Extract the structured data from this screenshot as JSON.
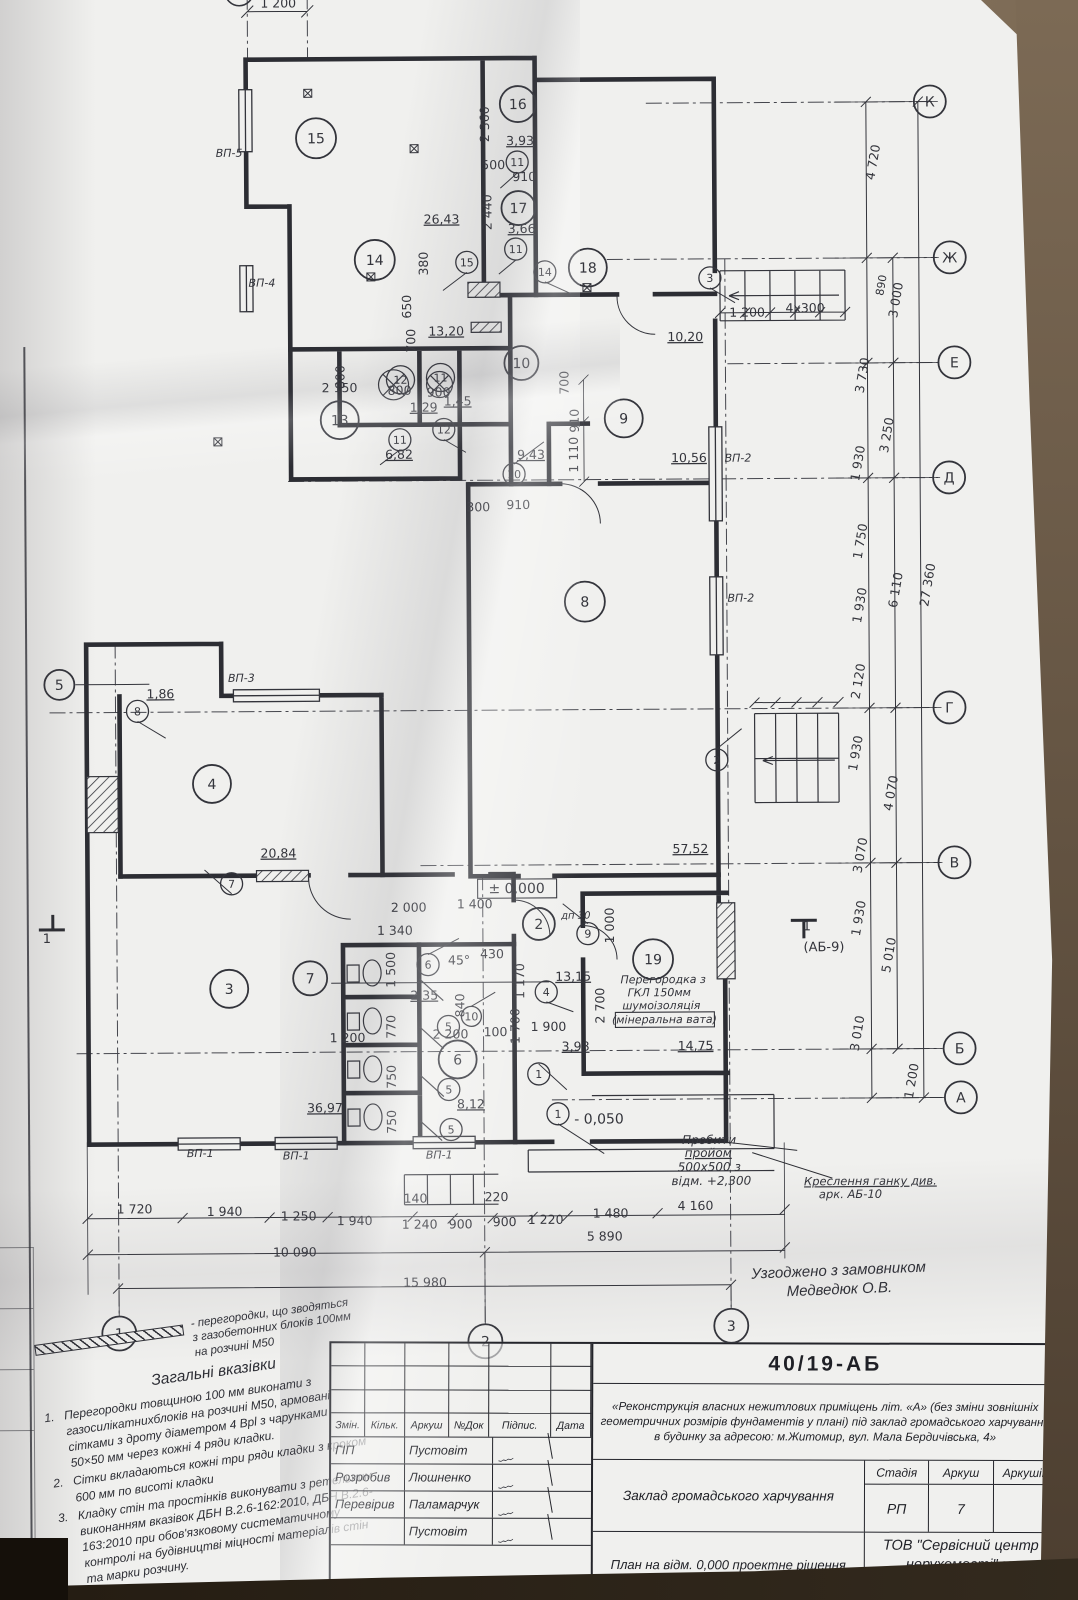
{
  "agreement": {
    "line1": "Узгоджено з замовником",
    "line2": "Медведюк О.В."
  },
  "notes": {
    "legend": "- перегородки, що зводяться з газобетонних блоків 100мм на розчині М50",
    "title": "Загальні вказівки",
    "items": [
      {
        "num": "1.",
        "text": "Перегородки товщиною 100 мм виконати з газосилікатнихблоків на розчині М50, армовані сітками з дроту діаметром 4 Врl з чарунками 50×50 мм через кожні 4 ряди кладки."
      },
      {
        "num": "2.",
        "text": "Сітки вкладаються кожні три ряди кладки з кроком 600 мм по висоті кладки"
      },
      {
        "num": "3.",
        "text": "Кладку стін та простінків виконувати з ретельним виконанням вказівок ДБН В.2.6-162:2010, ДБН В.2.6-163:2010 при обов'язковому систематичному контролі на будівництві міцності матеріалів стін та марки розчину."
      }
    ]
  },
  "titleblock": {
    "doc_number": "40/19-АБ",
    "project_text": "«Реконструкція власних нежитлових приміщень літ. «А» (без зміни зовнішніх геометричних розмірів фундаментів у плані) під заклад громадського харчування в будинку за адресою: м.Житомир, вул. Мала Бердичівська, 4»",
    "object_label": "Заклад громадського харчування",
    "stage_header": "Стадія",
    "sheet_header": "Аркуш",
    "sheets_header": "Аркушів",
    "stage_value": "РП",
    "sheet_value": "7",
    "sheets_value": "",
    "drawing_title": "План на відм. 0,000 проектне рішення",
    "org": "ТОВ \"Сервісний центр нерухомості\" м. Житомир.",
    "sig_headers": [
      "Змін.",
      "Кільк.",
      "Аркуш",
      "№Док",
      "Підпис.",
      "Дата"
    ],
    "sig_rows": [
      {
        "role": "ГІП",
        "name": "Пустовіт"
      },
      {
        "role": "Розробив",
        "name": "Люшненко"
      },
      {
        "role": "Перевірив",
        "name": "Паламарчук"
      },
      {
        "role": "",
        "name": "Пустовіт"
      }
    ]
  },
  "plan": {
    "ink": "#33343b",
    "texts": [
      {
        "t": "1 200",
        "x": 293,
        "y": 14
      },
      {
        "t": "2 360",
        "x": 503,
        "y": 132,
        "r": -90
      },
      {
        "t": "3,93",
        "x": 534,
        "y": 153,
        "u": 1
      },
      {
        "t": "500",
        "x": 507,
        "y": 177
      },
      {
        "t": "910",
        "x": 538,
        "y": 189
      },
      {
        "t": "2 440",
        "x": 505,
        "y": 220,
        "r": -90
      },
      {
        "t": "3,66",
        "x": 535,
        "y": 241,
        "u": 1
      },
      {
        "t": "26,43",
        "x": 455,
        "y": 231,
        "u": 1,
        "n": "area-label"
      },
      {
        "t": "380",
        "x": 441,
        "y": 271,
        "r": -90
      },
      {
        "t": "650",
        "x": 424,
        "y": 314,
        "r": -90
      },
      {
        "t": "700",
        "x": 428,
        "y": 348,
        "r": -90
      },
      {
        "t": "13,20",
        "x": 459,
        "y": 343,
        "u": 1,
        "n": "area-label"
      },
      {
        "t": "10,20",
        "x": 698,
        "y": 350,
        "u": 1,
        "n": "area-label"
      },
      {
        "t": "1 200",
        "x": 760,
        "y": 326
      },
      {
        "t": "4x300",
        "x": 818,
        "y": 322
      },
      {
        "t": "800",
        "x": 357,
        "y": 384,
        "r": -90
      },
      {
        "t": "2 150",
        "x": 352,
        "y": 399
      },
      {
        "t": "800",
        "x": 412,
        "y": 402
      },
      {
        "t": "900",
        "x": 451,
        "y": 404
      },
      {
        "t": "700",
        "x": 581,
        "y": 391,
        "r": -90
      },
      {
        "t": "910",
        "x": 591,
        "y": 429,
        "r": -90
      },
      {
        "t": "1 110",
        "x": 590,
        "y": 463,
        "r": -90
      },
      {
        "t": "1,29",
        "x": 436,
        "y": 419,
        "u": 1
      },
      {
        "t": "1,45",
        "x": 470,
        "y": 413,
        "u": 1
      },
      {
        "t": "6,82",
        "x": 411,
        "y": 466,
        "u": 1,
        "n": "area-label"
      },
      {
        "t": "9,43",
        "x": 543,
        "y": 467,
        "u": 1,
        "n": "area-label"
      },
      {
        "t": "10,56",
        "x": 701,
        "y": 471,
        "u": 1,
        "n": "area-label"
      },
      {
        "t": "300",
        "x": 490,
        "y": 519
      },
      {
        "t": "910",
        "x": 530,
        "y": 517
      },
      {
        "t": "1,86",
        "x": 171,
        "y": 704,
        "u": 1
      },
      {
        "t": "20,84",
        "x": 288,
        "y": 864,
        "u": 1,
        "n": "area-label"
      },
      {
        "t": "57,52",
        "x": 700,
        "y": 862,
        "u": 1,
        "n": "area-label"
      },
      {
        "t": "± 0,000",
        "x": 526,
        "y": 901,
        "s": 14,
        "n": "level-mark"
      },
      {
        "t": "2 000",
        "x": 418,
        "y": 919
      },
      {
        "t": "1 400",
        "x": 484,
        "y": 916
      },
      {
        "t": "1 340",
        "x": 404,
        "y": 942
      },
      {
        "t": "1 000",
        "x": 623,
        "y": 934,
        "r": -90
      },
      {
        "t": "дп 30",
        "x": 585,
        "y": 927,
        "s": 10,
        "i": 1
      },
      {
        "t": "45°",
        "x": 468,
        "y": 972
      },
      {
        "t": "430",
        "x": 501,
        "y": 966
      },
      {
        "t": "1 170",
        "x": 533,
        "y": 989,
        "r": -90
      },
      {
        "t": "13,15",
        "x": 582,
        "y": 989,
        "u": 1,
        "n": "area-label"
      },
      {
        "t": "2,35",
        "x": 433,
        "y": 1007,
        "u": 1
      },
      {
        "t": "840",
        "x": 473,
        "y": 1013,
        "r": -90
      },
      {
        "t": "1 500",
        "x": 404,
        "y": 977,
        "r": -90
      },
      {
        "t": "100",
        "x": 504,
        "y": 1044
      },
      {
        "t": "1 700",
        "x": 528,
        "y": 1034,
        "r": -90
      },
      {
        "t": "1 900",
        "x": 557,
        "y": 1039
      },
      {
        "t": "2 700",
        "x": 613,
        "y": 1014,
        "r": -90
      },
      {
        "t": "1 200",
        "x": 356,
        "y": 1049
      },
      {
        "t": "770",
        "x": 404,
        "y": 1034,
        "r": -90
      },
      {
        "t": "2 200",
        "x": 459,
        "y": 1046
      },
      {
        "t": "750",
        "x": 404,
        "y": 1084,
        "r": -90
      },
      {
        "t": "750",
        "x": 404,
        "y": 1129,
        "r": -90
      },
      {
        "t": "3,98",
        "x": 584,
        "y": 1059,
        "u": 1
      },
      {
        "t": "14,75",
        "x": 704,
        "y": 1059,
        "u": 1,
        "n": "area-label"
      },
      {
        "t": "36,97",
        "x": 333,
        "y": 1119,
        "u": 1,
        "n": "area-label"
      },
      {
        "t": "8,12",
        "x": 479,
        "y": 1116,
        "u": 1,
        "n": "area-label"
      },
      {
        "t": "- 0,050",
        "x": 607,
        "y": 1132,
        "s": 14,
        "n": "level-mark"
      },
      {
        "t": "140",
        "x": 423,
        "y": 1210
      },
      {
        "t": "220",
        "x": 504,
        "y": 1209
      },
      {
        "t": "1 720",
        "x": 142,
        "y": 1219
      },
      {
        "t": "1 940",
        "x": 232,
        "y": 1222
      },
      {
        "t": "1 250",
        "x": 306,
        "y": 1227
      },
      {
        "t": "1 940",
        "x": 362,
        "y": 1232
      },
      {
        "t": "1 240",
        "x": 427,
        "y": 1236
      },
      {
        "t": "900",
        "x": 468,
        "y": 1236
      },
      {
        "t": "900",
        "x": 512,
        "y": 1234
      },
      {
        "t": "1 220",
        "x": 553,
        "y": 1232
      },
      {
        "t": "1 480",
        "x": 618,
        "y": 1226
      },
      {
        "t": "4 160",
        "x": 703,
        "y": 1219
      },
      {
        "t": "10 090",
        "x": 302,
        "y": 1263
      },
      {
        "t": "5 890",
        "x": 612,
        "y": 1249
      },
      {
        "t": "15 980",
        "x": 432,
        "y": 1294
      },
      {
        "t": "4 720",
        "x": 891,
        "y": 173,
        "r": -80
      },
      {
        "t": "890",
        "x": 898,
        "y": 296,
        "r": -80,
        "s": 11
      },
      {
        "t": "3 000",
        "x": 913,
        "y": 311,
        "r": -80
      },
      {
        "t": "3 730",
        "x": 879,
        "y": 386,
        "r": -80
      },
      {
        "t": "3 250",
        "x": 903,
        "y": 446,
        "r": -80
      },
      {
        "t": "1 930",
        "x": 874,
        "y": 474,
        "r": -80
      },
      {
        "t": "1 750",
        "x": 876,
        "y": 552,
        "r": -80
      },
      {
        "t": "6 110",
        "x": 911,
        "y": 601,
        "r": -80
      },
      {
        "t": "27 360",
        "x": 943,
        "y": 596,
        "r": -80
      },
      {
        "t": "1 930",
        "x": 875,
        "y": 616,
        "r": -80
      },
      {
        "t": "2 120",
        "x": 873,
        "y": 692,
        "r": -80
      },
      {
        "t": "1 930",
        "x": 870,
        "y": 764,
        "r": -80
      },
      {
        "t": "4 070",
        "x": 905,
        "y": 804,
        "r": -80
      },
      {
        "t": "3 070",
        "x": 874,
        "y": 866,
        "r": -80
      },
      {
        "t": "1 930",
        "x": 872,
        "y": 929,
        "r": -80
      },
      {
        "t": "5 010",
        "x": 902,
        "y": 966,
        "r": -80
      },
      {
        "t": "3 010",
        "x": 870,
        "y": 1044,
        "r": -80
      },
      {
        "t": "1 200",
        "x": 924,
        "y": 1092,
        "r": -80
      },
      {
        "t": "ВП-5",
        "x": 243,
        "y": 163,
        "s": 11,
        "i": 1,
        "n": "wall-type-label"
      },
      {
        "t": "ВП-4",
        "x": 275,
        "y": 293,
        "s": 11,
        "i": 1,
        "n": "wall-type-label"
      },
      {
        "t": "ВП-3",
        "x": 252,
        "y": 688,
        "s": 11,
        "i": 1,
        "n": "wall-type-label"
      },
      {
        "t": "ВП-2",
        "x": 750,
        "y": 471,
        "s": 11,
        "i": 1,
        "n": "wall-type-label"
      },
      {
        "t": "ВП-2",
        "x": 752,
        "y": 611,
        "s": 11,
        "i": 1,
        "n": "wall-type-label"
      },
      {
        "t": "ВП-1",
        "x": 208,
        "y": 1163,
        "s": 11,
        "i": 1,
        "n": "wall-type-label"
      },
      {
        "t": "ВП-1",
        "x": 304,
        "y": 1166,
        "s": 11,
        "i": 1,
        "n": "wall-type-label"
      },
      {
        "t": "ВП-1",
        "x": 447,
        "y": 1166,
        "s": 11,
        "i": 1,
        "n": "wall-type-label"
      },
      {
        "t": "1",
        "x": 816,
        "y": 940,
        "s": 13,
        "n": "section-mark"
      },
      {
        "t": "(АБ-9)",
        "x": 833,
        "y": 961,
        "s": 13,
        "n": "section-mark"
      },
      {
        "t": "1",
        "x": 56,
        "y": 948,
        "s": 13,
        "n": "section-mark"
      },
      {
        "t": "Перегородка з",
        "x": 672,
        "y": 992,
        "s": 11,
        "i": 1,
        "n": "annotation"
      },
      {
        "t": "ГКЛ 150мм",
        "x": 668,
        "y": 1005,
        "s": 11,
        "i": 1,
        "n": "annotation"
      },
      {
        "t": "шумоізоляція",
        "x": 670,
        "y": 1018,
        "s": 11,
        "i": 1,
        "n": "annotation"
      },
      {
        "t": "(мінеральна вата)",
        "x": 673,
        "y": 1032,
        "s": 11,
        "i": 1,
        "n": "annotation"
      },
      {
        "t": "Пробити",
        "x": 717,
        "y": 1153,
        "s": 12,
        "i": 1,
        "n": "annotation"
      },
      {
        "t": "пройом",
        "x": 716,
        "y": 1166,
        "s": 12,
        "i": 1,
        "u": 1,
        "n": "annotation"
      },
      {
        "t": "500х500 з",
        "x": 717,
        "y": 1180,
        "s": 12,
        "i": 1,
        "n": "annotation"
      },
      {
        "t": "відм. +2,300",
        "x": 719,
        "y": 1194,
        "s": 12,
        "i": 1,
        "n": "annotation"
      },
      {
        "t": "Креслення ганку див.",
        "x": 878,
        "y": 1195,
        "s": 11.5,
        "i": 1,
        "u": 1,
        "n": "annotation"
      },
      {
        "t": "арк. АБ-10",
        "x": 858,
        "y": 1208,
        "s": 11.5,
        "i": 1,
        "n": "annotation"
      }
    ],
    "circles": [
      {
        "t": "15",
        "x": 330,
        "y": 145,
        "r": 20,
        "k": "room-number"
      },
      {
        "t": "16",
        "x": 532,
        "y": 112,
        "r": 18,
        "k": "room-number"
      },
      {
        "t": "17",
        "x": 532,
        "y": 216,
        "r": 17,
        "k": "room-number"
      },
      {
        "t": "14",
        "x": 388,
        "y": 267,
        "r": 20,
        "k": "room-number"
      },
      {
        "t": "18",
        "x": 601,
        "y": 276,
        "r": 19,
        "k": "room-number"
      },
      {
        "t": "13",
        "x": 352,
        "y": 427,
        "r": 19,
        "k": "room-number"
      },
      {
        "t": "12",
        "x": 413,
        "y": 387,
        "r": 14,
        "k": "room-number"
      },
      {
        "t": "11",
        "x": 453,
        "y": 385,
        "r": 14,
        "k": "room-number"
      },
      {
        "t": "10",
        "x": 534,
        "y": 371,
        "r": 17,
        "k": "room-number"
      },
      {
        "t": "9",
        "x": 636,
        "y": 427,
        "r": 19,
        "k": "room-number"
      },
      {
        "t": "8",
        "x": 596,
        "y": 610,
        "r": 20,
        "k": "room-number"
      },
      {
        "t": "4",
        "x": 222,
        "y": 790,
        "r": 19,
        "k": "room-number"
      },
      {
        "t": "3",
        "x": 238,
        "y": 995,
        "r": 19,
        "k": "room-number"
      },
      {
        "t": "7",
        "x": 319,
        "y": 985,
        "r": 17,
        "k": "room-number"
      },
      {
        "t": "6",
        "x": 466,
        "y": 1067,
        "r": 19,
        "k": "room-number"
      },
      {
        "t": "19",
        "x": 662,
        "y": 968,
        "r": 20,
        "k": "room-number"
      },
      {
        "t": "2",
        "x": 548,
        "y": 932,
        "r": 16,
        "k": "room-number"
      },
      {
        "t": "11",
        "x": 531,
        "y": 170,
        "r": 11,
        "k": "door-number"
      },
      {
        "t": "11",
        "x": 529,
        "y": 257,
        "r": 11,
        "k": "door-number"
      },
      {
        "t": "15",
        "x": 480,
        "y": 270,
        "r": 11,
        "k": "door-number"
      },
      {
        "t": "14",
        "x": 558,
        "y": 280,
        "r": 11,
        "k": "door-number"
      },
      {
        "t": "3",
        "x": 723,
        "y": 287,
        "r": 11,
        "k": "door-number"
      },
      {
        "t": "11",
        "x": 412,
        "y": 447,
        "r": 11,
        "k": "door-number"
      },
      {
        "t": "12",
        "x": 456,
        "y": 437,
        "r": 11,
        "k": "door-number"
      },
      {
        "t": "10",
        "x": 526,
        "y": 482,
        "r": 11,
        "k": "door-number"
      },
      {
        "t": "8",
        "x": 148,
        "y": 717,
        "r": 11,
        "k": "door-number"
      },
      {
        "t": "7",
        "x": 241,
        "y": 890,
        "r": 11,
        "k": "door-number"
      },
      {
        "t": "2",
        "x": 727,
        "y": 769,
        "r": 11,
        "k": "door-number"
      },
      {
        "t": "9",
        "x": 597,
        "y": 942,
        "r": 11,
        "k": "door-number"
      },
      {
        "t": "6",
        "x": 437,
        "y": 972,
        "r": 11,
        "k": "door-number"
      },
      {
        "t": "4",
        "x": 555,
        "y": 1000,
        "r": 11,
        "k": "door-number"
      },
      {
        "t": "10",
        "x": 480,
        "y": 1024,
        "r": 10,
        "k": "door-number"
      },
      {
        "t": "5",
        "x": 457,
        "y": 1034,
        "r": 11,
        "k": "door-number"
      },
      {
        "t": "5",
        "x": 457,
        "y": 1097,
        "r": 11,
        "k": "door-number"
      },
      {
        "t": "5",
        "x": 459,
        "y": 1137,
        "r": 11,
        "k": "door-number"
      },
      {
        "t": "1",
        "x": 547,
        "y": 1082,
        "r": 11,
        "k": "door-number"
      },
      {
        "t": "1",
        "x": 566,
        "y": 1122,
        "r": 11,
        "k": "door-number"
      },
      {
        "t": "К",
        "x": 944,
        "y": 112,
        "r": 16,
        "k": "axis-marker"
      },
      {
        "t": "Ж",
        "x": 963,
        "y": 268,
        "r": 16,
        "k": "axis-marker"
      },
      {
        "t": "Е",
        "x": 967,
        "y": 373,
        "r": 16,
        "k": "axis-marker"
      },
      {
        "t": "Д",
        "x": 961,
        "y": 488,
        "r": 16,
        "k": "axis-marker"
      },
      {
        "t": "Г",
        "x": 960,
        "y": 718,
        "r": 16,
        "k": "axis-marker"
      },
      {
        "t": "В",
        "x": 964,
        "y": 873,
        "r": 16,
        "k": "axis-marker"
      },
      {
        "t": "Б",
        "x": 968,
        "y": 1059,
        "r": 16,
        "k": "axis-marker"
      },
      {
        "t": "А",
        "x": 969,
        "y": 1108,
        "r": 16,
        "k": "axis-marker"
      },
      {
        "t": "5",
        "x": 70,
        "y": 690,
        "r": 15,
        "k": "axis-marker"
      },
      {
        "t": "1",
        "x": 126,
        "y": 1339,
        "r": 17,
        "k": "axis-marker"
      },
      {
        "t": "2",
        "x": 492,
        "y": 1349,
        "r": 17,
        "k": "axis-marker"
      },
      {
        "t": "3",
        "x": 738,
        "y": 1335,
        "r": 17,
        "k": "axis-marker"
      }
    ]
  }
}
